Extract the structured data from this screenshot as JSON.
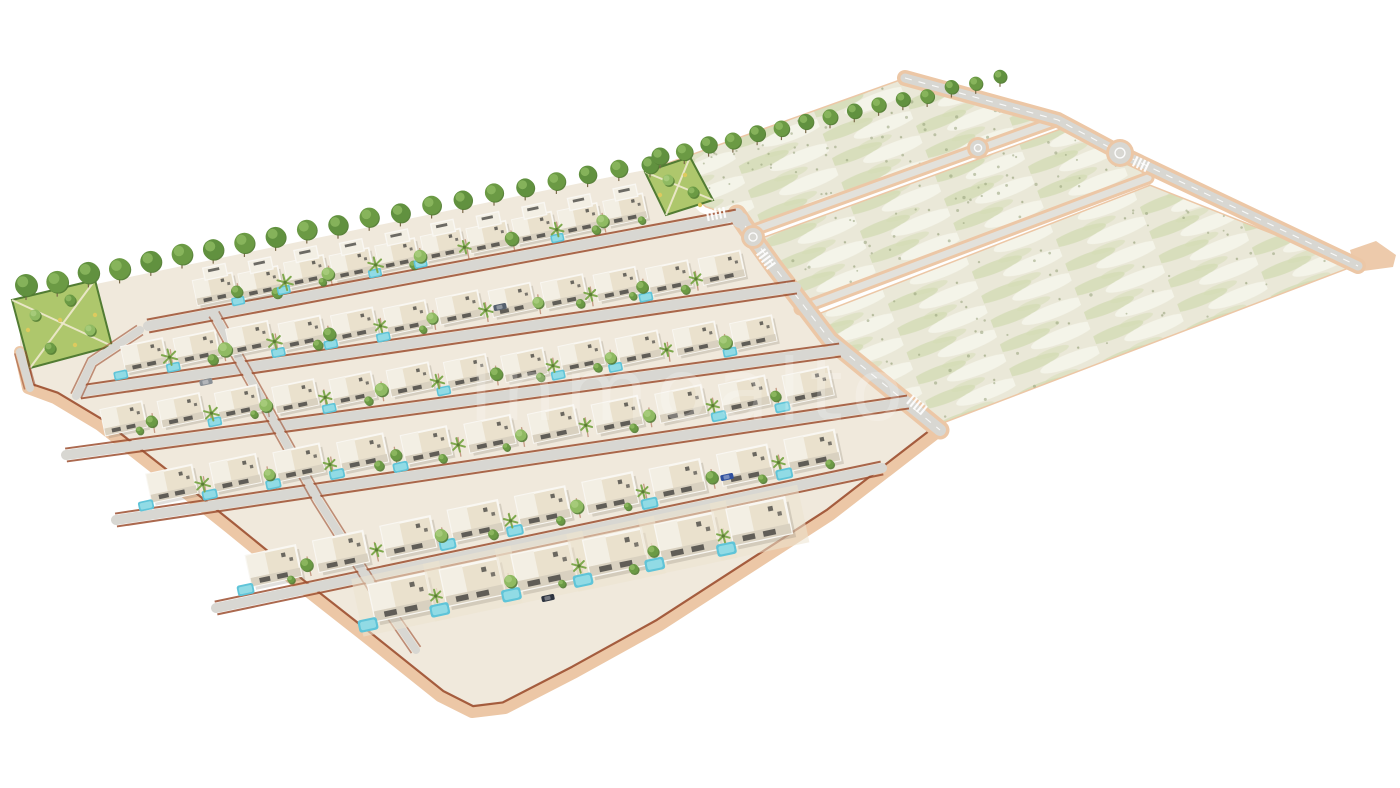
{
  "scene": {
    "type": "3d-aerial-render",
    "subject": "residential villa development with landscaped plots and undeveloped parcels",
    "watermark": "Inmoalto",
    "canvas": {
      "width": 1400,
      "height": 788,
      "background": "#ffffff"
    }
  },
  "palette": {
    "ground": "#f0e9dc",
    "road_gray": "#d8d7d2",
    "road_light": "#e2e1db",
    "sidewalk": "#ecc7a6",
    "sidewalk_deep": "#e2b088",
    "brick_wall": "#9c4f30",
    "house_roof": "#eae1cd",
    "house_white": "#f9f7f2",
    "house_wing": "#f3efe4",
    "house_shade": "#d9d1c0",
    "house_dark": "#4a4944",
    "pool": "#5fc4d8",
    "pool_light": "#9adfe8",
    "tree_green": "#6b9a44",
    "tree_light": "#8fba62",
    "tree_dark": "#527c33",
    "palm_green": "#7fa94e",
    "trunk": "#7a6a4a",
    "field_base": "#eae8d8",
    "field_green": "#c8d5a6",
    "field_green2": "#d4dcb4",
    "field_pale": "#f6f5ec",
    "speckle": "#8e9a72",
    "park_green": "#aec76c",
    "park_light": "#cfdf9a",
    "park_path": "#efe9cf",
    "park_dot": "#ddca5e",
    "white_line": "#ffffff",
    "shadow": "#786e5f",
    "watermark_fill": "#ffffff"
  },
  "villa_zone": {
    "outline": [
      [
        20,
        300
      ],
      [
        120,
        279
      ],
      [
        240,
        254
      ],
      [
        360,
        229
      ],
      [
        480,
        204
      ],
      [
        600,
        179
      ],
      [
        655,
        168
      ],
      [
        700,
        212
      ],
      [
        748,
        232
      ],
      [
        775,
        268
      ],
      [
        830,
        340
      ],
      [
        940,
        430
      ],
      [
        905,
        457
      ],
      [
        830,
        515
      ],
      [
        745,
        570
      ],
      [
        660,
        625
      ],
      [
        575,
        672
      ],
      [
        505,
        708
      ],
      [
        472,
        712
      ],
      [
        440,
        696
      ],
      [
        370,
        640
      ],
      [
        300,
        585
      ],
      [
        230,
        528
      ],
      [
        160,
        472
      ],
      [
        100,
        425
      ],
      [
        55,
        398
      ],
      [
        28,
        388
      ],
      [
        20,
        352
      ]
    ],
    "bottom_edge": [
      [
        20,
        352
      ],
      [
        28,
        388
      ],
      [
        55,
        398
      ],
      [
        100,
        425
      ],
      [
        160,
        472
      ],
      [
        230,
        528
      ],
      [
        300,
        585
      ],
      [
        370,
        640
      ],
      [
        440,
        696
      ],
      [
        472,
        712
      ],
      [
        505,
        708
      ],
      [
        575,
        672
      ],
      [
        660,
        625
      ],
      [
        745,
        570
      ],
      [
        830,
        515
      ],
      [
        905,
        457
      ],
      [
        940,
        430
      ]
    ]
  },
  "parks": [
    {
      "name": "west-park",
      "points": [
        [
          12,
          300
        ],
        [
          95,
          280
        ],
        [
          112,
          346
        ],
        [
          30,
          368
        ]
      ],
      "trees": [
        [
          35,
          315
        ],
        [
          70,
          300
        ],
        [
          90,
          330
        ],
        [
          50,
          348
        ]
      ],
      "dots": [
        [
          28,
          330
        ],
        [
          60,
          320
        ],
        [
          95,
          315
        ],
        [
          75,
          345
        ]
      ]
    },
    {
      "name": "mid-park",
      "points": [
        [
          645,
          172
        ],
        [
          690,
          157
        ],
        [
          713,
          200
        ],
        [
          666,
          215
        ]
      ],
      "trees": [
        [
          668,
          180
        ],
        [
          693,
          192
        ]
      ],
      "dots": [
        [
          660,
          195
        ],
        [
          685,
          175
        ],
        [
          700,
          205
        ]
      ]
    }
  ],
  "tree_lines": [
    {
      "x1": 26,
      "y1": 286,
      "x2": 650,
      "y2": 163,
      "n": 21,
      "r1": 11,
      "r2": 8.5
    },
    {
      "x1": 660,
      "y1": 157,
      "x2": 1000,
      "y2": 77,
      "n": 15,
      "r1": 8.5,
      "r2": 6.5
    }
  ],
  "fields": {
    "strips": [
      {
        "points": [
          [
            662,
            166
          ],
          [
            905,
            79
          ],
          [
            1052,
            117
          ],
          [
            758,
            225
          ],
          [
            706,
            206
          ]
        ],
        "quad": [
          [
            666,
            170
          ],
          [
            903,
            82
          ],
          [
            1050,
            120
          ],
          [
            758,
            224
          ]
        ]
      },
      {
        "points": [
          [
            764,
            238
          ],
          [
            1060,
            130
          ],
          [
            1116,
            153
          ],
          [
            1146,
            176
          ],
          [
            802,
            306
          ],
          [
            772,
            262
          ]
        ],
        "quad": [
          [
            768,
            240
          ],
          [
            1062,
            132
          ],
          [
            1146,
            178
          ],
          [
            804,
            306
          ]
        ]
      },
      {
        "points": [
          [
            810,
            318
          ],
          [
            1150,
            186
          ],
          [
            1352,
            266
          ],
          [
            938,
            424
          ],
          [
            832,
            342
          ]
        ],
        "quad": [
          [
            812,
            320
          ],
          [
            1152,
            188
          ],
          [
            1352,
            266
          ],
          [
            940,
            422
          ]
        ]
      }
    ],
    "roads": [
      {
        "x1": 757,
        "y1": 229,
        "x2": 1056,
        "y2": 121,
        "w": 7
      },
      {
        "x1": 800,
        "y1": 309,
        "x2": 1148,
        "y2": 178,
        "w": 7
      }
    ],
    "edge_road": {
      "points": [
        [
          905,
          78
        ],
        [
          1058,
          120
        ],
        [
          1120,
          153
        ],
        [
          1358,
          266
        ]
      ],
      "w": 9
    },
    "roundabouts": [
      {
        "x": 1120,
        "y": 153,
        "r": 11
      },
      {
        "x": 978,
        "y": 148,
        "r": 8
      }
    ],
    "tip_pad": [
      [
        1350,
        250
      ],
      [
        1376,
        241
      ],
      [
        1396,
        255
      ],
      [
        1393,
        267
      ],
      [
        1356,
        272
      ]
    ]
  },
  "main_road": {
    "points": [
      [
        737,
        214
      ],
      [
        752,
        236
      ],
      [
        775,
        268
      ],
      [
        830,
        340
      ],
      [
        940,
        430
      ]
    ],
    "w": 12
  },
  "mini_roundabout": {
    "x": 753,
    "y": 237,
    "r": 9
  },
  "junction_pads": [
    {
      "x": 740,
      "y": 220,
      "r": 8
    }
  ],
  "streets": [
    {
      "x1": 148,
      "y1": 326,
      "x2": 737,
      "y2": 216,
      "w": 10
    },
    {
      "x1": 80,
      "y1": 392,
      "x2": 796,
      "y2": 287,
      "w": 10
    },
    {
      "x1": 66,
      "y1": 455,
      "x2": 840,
      "y2": 350,
      "w": 10
    },
    {
      "x1": 116,
      "y1": 520,
      "x2": 908,
      "y2": 402,
      "w": 10
    },
    {
      "x1": 216,
      "y1": 608,
      "x2": 882,
      "y2": 468,
      "w": 10
    }
  ],
  "cross_streets": [
    {
      "points": [
        [
          140,
          330
        ],
        [
          92,
          362
        ],
        [
          76,
          396
        ]
      ],
      "w": 8
    },
    {
      "points": [
        [
          214,
          314
        ],
        [
          262,
          400
        ],
        [
          318,
          500
        ],
        [
          376,
          592
        ],
        [
          416,
          650
        ]
      ],
      "w": 8
    },
    {
      "points": [
        [
          20,
          352
        ],
        [
          30,
          388
        ]
      ],
      "w": 8
    }
  ],
  "rows": [
    {
      "x1": 192,
      "y1": 294,
      "x2": 648,
      "y2": 206,
      "n": 10,
      "s": 0.95,
      "two": true
    },
    {
      "x1": 118,
      "y1": 359,
      "x2": 748,
      "y2": 265,
      "n": 12,
      "s": 1.0,
      "two": false
    },
    {
      "x1": 95,
      "y1": 423,
      "x2": 782,
      "y2": 328,
      "n": 12,
      "s": 1.0,
      "two": false
    },
    {
      "x1": 140,
      "y1": 488,
      "x2": 840,
      "y2": 380,
      "n": 11,
      "s": 1.1,
      "two": false
    },
    {
      "x1": 240,
      "y1": 573,
      "x2": 846,
      "y2": 442,
      "n": 9,
      "s": 1.2,
      "two": false
    },
    {
      "x1": 365,
      "y1": 605,
      "x2": 795,
      "y2": 515,
      "n": 6,
      "s": 1.4,
      "two": false
    }
  ],
  "crosswalks": [
    {
      "x": 716,
      "y": 214,
      "dir": -11,
      "n": 5
    },
    {
      "x": 766,
      "y": 259,
      "dir": 54,
      "n": 5
    },
    {
      "x": 917,
      "y": 405,
      "dir": 39,
      "n": 5
    },
    {
      "x": 1141,
      "y": 164,
      "dir": 25,
      "n": 4
    }
  ],
  "cars": [
    {
      "x": 206,
      "y": 382,
      "color": "#8a9096"
    },
    {
      "x": 500,
      "y": 307,
      "color": "#55606e"
    },
    {
      "x": 548,
      "y": 598,
      "color": "#2e3440"
    },
    {
      "x": 727,
      "y": 477,
      "color": "#30509e"
    }
  ],
  "watermark_style": {
    "x": 690,
    "y": 420,
    "size": 86,
    "opacity": 0.2,
    "spacing": 8
  }
}
